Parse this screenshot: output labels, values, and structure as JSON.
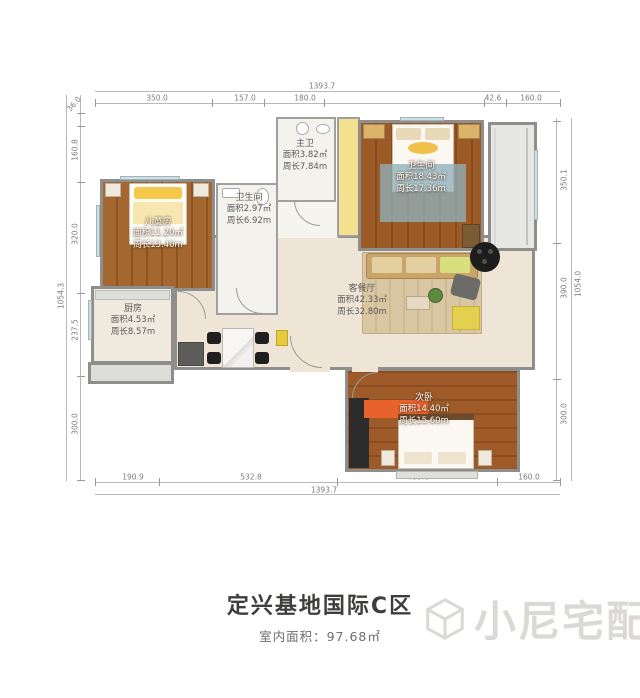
{
  "title": {
    "text": "定兴基地国际C区",
    "subtitle": "室内面积：97.68㎡"
  },
  "watermark": {
    "text": "小尼宅配"
  },
  "palette": {
    "wood_dark": "#9c5a27",
    "wood_mid": "#a4672f",
    "floor_beige": "#efe5d6",
    "bath_floor": "#f4f2ed",
    "wall_gray": "#8e8e8c",
    "cabinet_yellow": "#f3e18f",
    "rug_orange": "#e8622d",
    "balcony_gray": "#e7e7e4",
    "rug_blue": "#8fb0ba"
  },
  "rooms": {
    "children": {
      "name": "儿童房",
      "area": "面积11.20㎡",
      "perimeter": "周长13.40m"
    },
    "bathroom": {
      "name": "卫生间",
      "area": "面积2.97㎡",
      "perimeter": "周长6.92m"
    },
    "master_bath": {
      "name": "主卫",
      "area": "面积3.82㎡",
      "perimeter": "周长7.84m"
    },
    "master_bedroom": {
      "name": "卫生间",
      "area": "面积18.43㎡",
      "perimeter": "周长17.36m"
    },
    "kitchen": {
      "name": "厨房",
      "area": "面积4.53㎡",
      "perimeter": "周长8.57m"
    },
    "living": {
      "name": "客餐厅",
      "area": "面积42.33㎡",
      "perimeter": "周长32.80m"
    },
    "second_bedroom": {
      "name": "次卧",
      "area": "面积14.40㎡",
      "perimeter": "周长15.60m"
    }
  },
  "dimensions": {
    "top": {
      "total": "1393.7",
      "segments": [
        "350.0",
        "157.0",
        "180.0",
        "42.6",
        "160.0"
      ]
    },
    "bottom": {
      "total": "1393.7",
      "segments": [
        "190.9",
        "532.8",
        "480.0",
        "160.0"
      ]
    },
    "left": {
      "total": "1054.3",
      "segments": [
        "36.0",
        "160.8",
        "320.0",
        "237.5",
        "300.0"
      ]
    },
    "right": {
      "total": "1054.0",
      "segments": [
        "350.1",
        "390.0",
        "300.0"
      ]
    }
  }
}
